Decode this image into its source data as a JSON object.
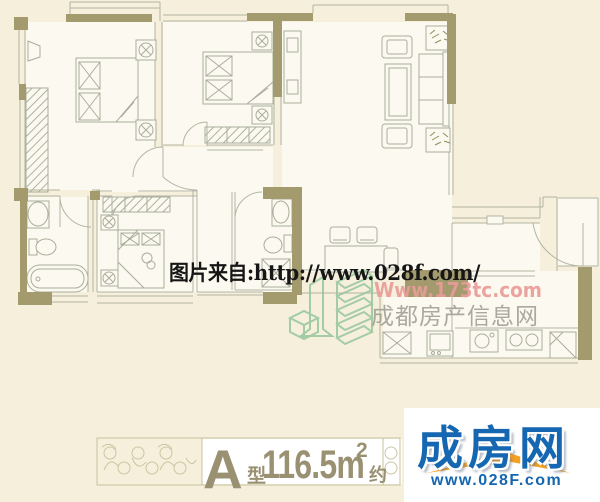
{
  "watermarks": {
    "source": "图片来自:http://www.028f.com/",
    "site_url": "Www.173tc.com",
    "site_name": "成都房产信息网"
  },
  "footer": {
    "unit": {
      "letter": "A",
      "type_suffix": "型",
      "area": "116.5m",
      "area_sup": "2",
      "approx": "约"
    },
    "brand": {
      "name": "成房网",
      "url": "www.028F.com"
    }
  },
  "colors": {
    "background": "#f5efdb",
    "room_fill": "#fcfaf0",
    "wall_olive": "#a39a6e",
    "plan_line": "#b2b6a3",
    "watermark_text": "#161616",
    "watermark_pink": "#e89b98",
    "watermark_gray": "#9e9d92",
    "logo_green": "#8fc498",
    "footer_olive": "#9a9072",
    "brand_blue": "#1467b0",
    "brand_orange": "#f6a01e"
  }
}
